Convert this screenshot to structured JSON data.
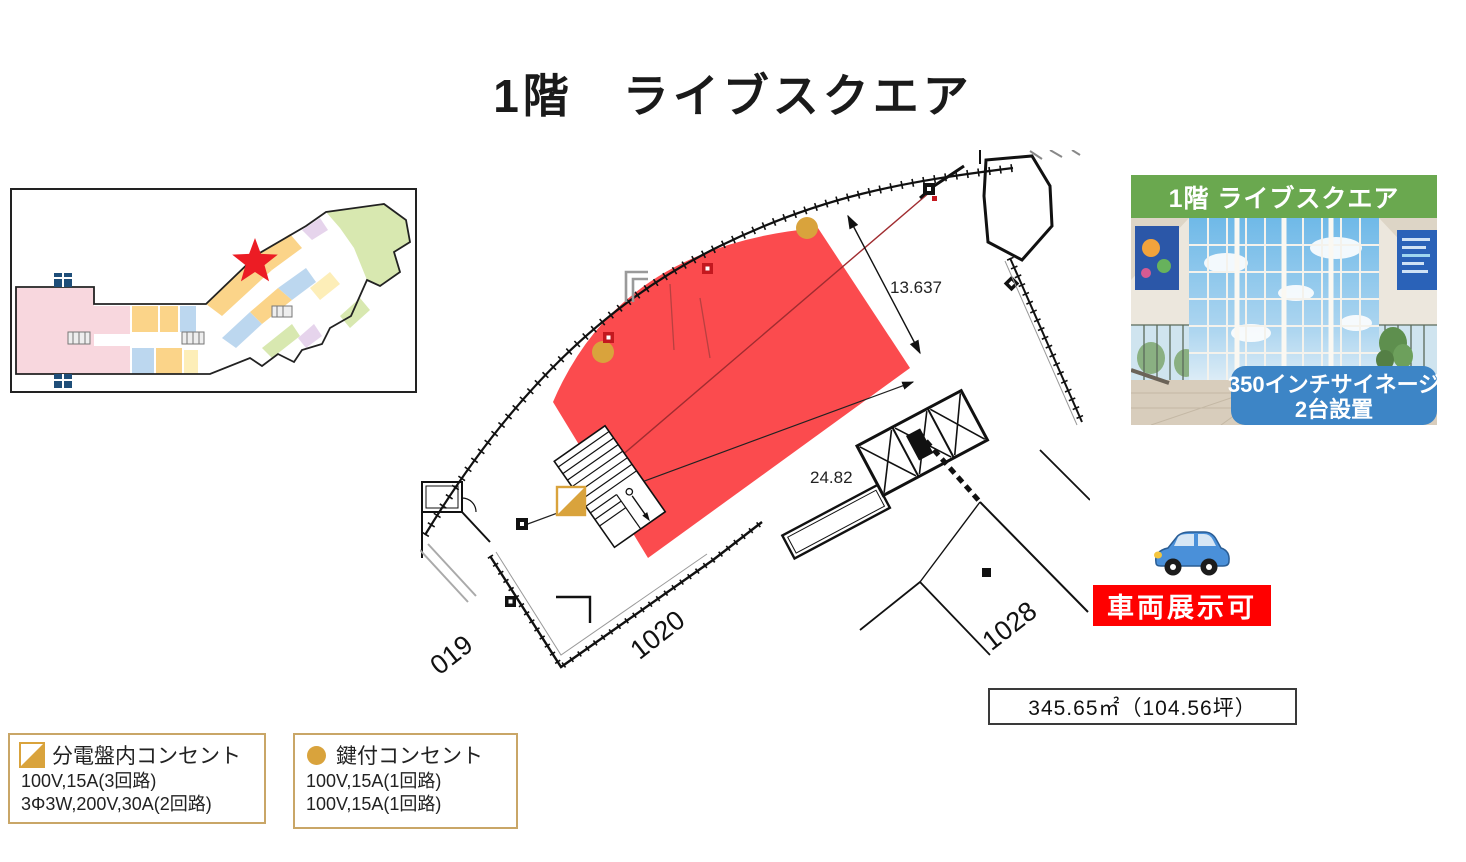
{
  "slide": {
    "title": "1階　ライブスクエア"
  },
  "floor_plan": {
    "dim_width": "13.637",
    "dim_length": "24.82",
    "room_1019": "019",
    "room_1020": "1020",
    "room_1028": "1028"
  },
  "area_box": {
    "label": "345.65㎡（104.56坪）"
  },
  "photo": {
    "header": "1階 ライブスクエア",
    "signage_line1": "350インチサイネージ",
    "signage_line2": "2台設置"
  },
  "vehicle": {
    "banner": "車両展示可",
    "icon": "car-icon"
  },
  "legends": {
    "panel_outlet": {
      "title": "分電盤内コンセント",
      "line1": "100V,15A(3回路)",
      "line2": "3Φ3W,200V,30A(2回路)"
    },
    "keyed_outlet": {
      "title": "鍵付コンセント",
      "line1": "100V,15A(1回路)",
      "line2": "100V,15A(1回路)"
    }
  },
  "overview_map": {
    "marker": "location-star-icon"
  },
  "colors": {
    "highlight_area": "#fb4b4e",
    "gold_marker": "#d9a33c",
    "photo_header_green": "#6aa84f",
    "signage_blue": "#3d85c6",
    "banner_red": "#ff0000",
    "star_red": "#ec1c24",
    "legend_border": "#c9a667"
  }
}
